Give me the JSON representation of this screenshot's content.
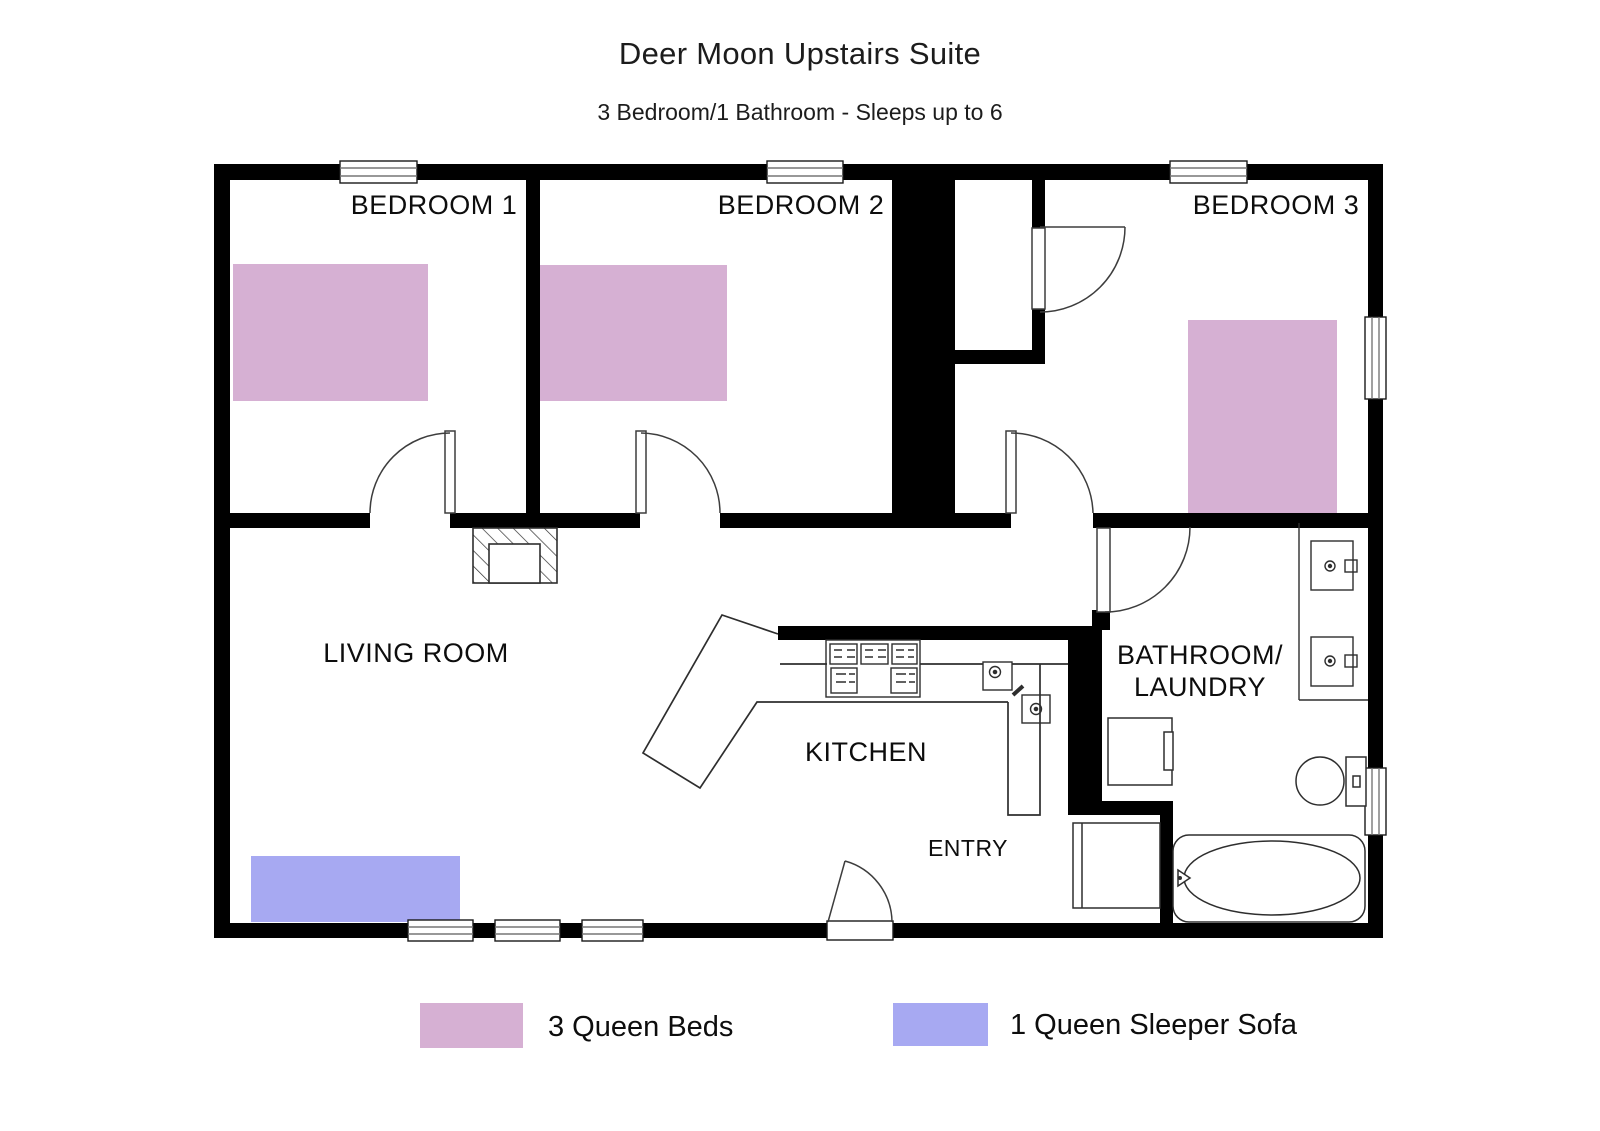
{
  "title": "Deer Moon Upstairs Suite",
  "subtitle": "3 Bedroom/1 Bathroom - Sleeps up to 6",
  "colors": {
    "bed": "#d6b0d3",
    "sofa": "#a7a9f2",
    "wall": "#000000",
    "fixture_line": "#2e2e2e"
  },
  "rooms": {
    "bedroom1": "BEDROOM 1",
    "bedroom2": "BEDROOM 2",
    "bedroom3": "BEDROOM 3",
    "living": "LIVING ROOM",
    "kitchen": "KITCHEN",
    "entry": "ENTRY",
    "bath_line1": "BATHROOM/",
    "bath_line2": "LAUNDRY"
  },
  "legend": {
    "beds": "3 Queen Beds",
    "sofa": "1 Queen Sleeper Sofa"
  }
}
